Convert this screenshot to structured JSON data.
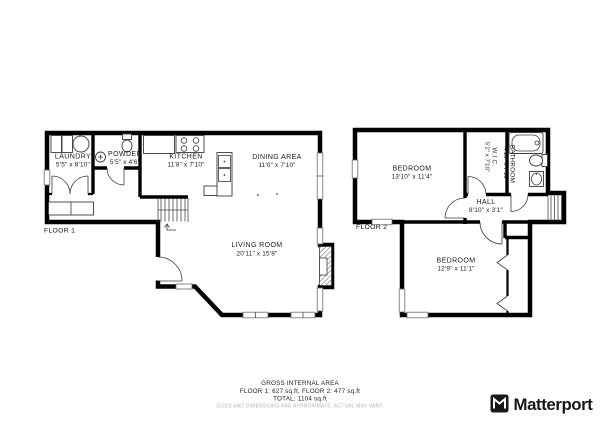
{
  "document": {
    "type": "floor-plan",
    "background": "#ffffff"
  },
  "colors": {
    "wall": "#000000",
    "fixture_line": "#3c3c3c",
    "text": "#1a1a1a",
    "disclaimer_text": "#b4b4b4",
    "brand": "#17181b"
  },
  "floor1": {
    "label": "FLOOR 1",
    "rooms": {
      "laundry": {
        "name": "LAUNDRY",
        "dims": "5'5\" x 8'10\""
      },
      "powder": {
        "name": "POWDER",
        "dims": "5'5\" x 4'6\""
      },
      "kitchen": {
        "name": "KITCHEN",
        "dims": "11'8\" x 7'10\""
      },
      "dining": {
        "name": "DINING AREA",
        "dims": "11'0\" x 7'10\""
      },
      "living": {
        "name": "LIVING ROOM",
        "dims": "20'11\" x 15'8\""
      }
    }
  },
  "floor2": {
    "label": "FLOOR 2",
    "rooms": {
      "bedroom1": {
        "name": "BEDROOM",
        "dims": "13'10\" x 11'4\""
      },
      "wic": {
        "name": "W.I.C.",
        "dims": "5'2\" x 7'10\""
      },
      "bathroom": {
        "name": "BATHROOM",
        "dims": "4'10\" x 7'10\""
      },
      "hall": {
        "name": "HALL",
        "dims": "8'10\" x 3'1\""
      },
      "bedroom2": {
        "name": "BEDROOM",
        "dims": "12'9\" x 11'1\""
      }
    }
  },
  "footer": {
    "title": "GROSS INTERNAL AREA",
    "areas": "FLOOR 1: 627 sq.ft, FLOOR 2: 477 sq.ft",
    "total": "TOTAL: 1104 sq.ft",
    "disclaimer": "SIZES AND DIMENSIONS ARE APPROXIMATE, ACTUAL MAY VARY."
  },
  "brand": {
    "name": "Matterport"
  }
}
